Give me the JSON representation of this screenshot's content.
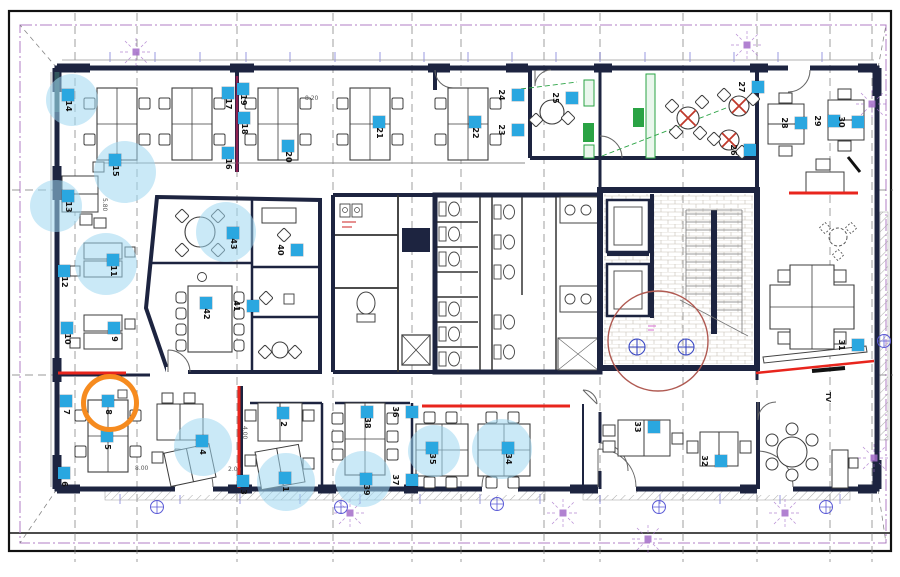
{
  "plan": {
    "title": "office-floor-plan",
    "colors": {
      "marker_blue": "#2aa7e0",
      "highlight_blue": "#9fd7f0",
      "orange_circle": "#f68b1f",
      "annotation_red": "#e8251d",
      "maroon_line": "#8e2050",
      "review_circle_red": "#b05a52",
      "wall_navy": "#1d2440",
      "kitchen_green": "#2aa344",
      "survey_purple": "#a36cc9"
    },
    "texts": {
      "tv_label": "TV",
      "dim_a": "8.20",
      "dim_b": "5.80",
      "dim_c": "8.00",
      "dim_d": "2.00",
      "dim_e": "4.00"
    },
    "markers": [
      {
        "n": "1",
        "x": 285,
        "y": 478
      },
      {
        "n": "2",
        "x": 283,
        "y": 413
      },
      {
        "n": "3",
        "x": 243,
        "y": 481
      },
      {
        "n": "4",
        "x": 202,
        "y": 441
      },
      {
        "n": "5",
        "x": 107,
        "y": 436
      },
      {
        "n": "6",
        "x": 64,
        "y": 473
      },
      {
        "n": "7",
        "x": 66,
        "y": 401
      },
      {
        "n": "8",
        "x": 108,
        "y": 401
      },
      {
        "n": "9",
        "x": 114,
        "y": 328
      },
      {
        "n": "10",
        "x": 67,
        "y": 328
      },
      {
        "n": "11",
        "x": 113,
        "y": 260
      },
      {
        "n": "12",
        "x": 64,
        "y": 271
      },
      {
        "n": "13",
        "x": 68,
        "y": 196
      },
      {
        "n": "14",
        "x": 68,
        "y": 95
      },
      {
        "n": "15",
        "x": 115,
        "y": 160
      },
      {
        "n": "16",
        "x": 228,
        "y": 153
      },
      {
        "n": "17",
        "x": 228,
        "y": 93
      },
      {
        "n": "18",
        "x": 244,
        "y": 118
      },
      {
        "n": "19",
        "x": 243,
        "y": 89
      },
      {
        "n": "20",
        "x": 288,
        "y": 146
      },
      {
        "n": "21",
        "x": 379,
        "y": 122
      },
      {
        "n": "22",
        "x": 475,
        "y": 122
      },
      {
        "n": "23",
        "x": 518,
        "y": 130,
        "ls": "l"
      },
      {
        "n": "24",
        "x": 518,
        "y": 95,
        "ls": "l"
      },
      {
        "n": "25",
        "x": 572,
        "y": 98,
        "ls": "l"
      },
      {
        "n": "26",
        "x": 750,
        "y": 150,
        "ls": "l"
      },
      {
        "n": "27",
        "x": 758,
        "y": 87,
        "ls": "l"
      },
      {
        "n": "28",
        "x": 801,
        "y": 123,
        "ls": "l"
      },
      {
        "n": "29",
        "x": 834,
        "y": 121,
        "ls": "l"
      },
      {
        "n": "30",
        "x": 858,
        "y": 122,
        "ls": "l"
      },
      {
        "n": "31",
        "x": 858,
        "y": 345,
        "ls": "l"
      },
      {
        "n": "32",
        "x": 721,
        "y": 461,
        "ls": "l"
      },
      {
        "n": "33",
        "x": 654,
        "y": 427,
        "ls": "l"
      },
      {
        "n": "34",
        "x": 508,
        "y": 448
      },
      {
        "n": "35",
        "x": 432,
        "y": 448
      },
      {
        "n": "36",
        "x": 412,
        "y": 412,
        "ls": "l"
      },
      {
        "n": "37",
        "x": 412,
        "y": 480,
        "ls": "l"
      },
      {
        "n": "38",
        "x": 367,
        "y": 412
      },
      {
        "n": "39",
        "x": 366,
        "y": 479
      },
      {
        "n": "40",
        "x": 297,
        "y": 250,
        "ls": "l"
      },
      {
        "n": "41",
        "x": 253,
        "y": 306,
        "ls": "l"
      },
      {
        "n": "42",
        "x": 206,
        "y": 303
      },
      {
        "n": "43",
        "x": 233,
        "y": 233
      }
    ],
    "highlights": [
      {
        "x": 72,
        "y": 100,
        "r": 26
      },
      {
        "x": 125,
        "y": 172,
        "r": 31
      },
      {
        "x": 56,
        "y": 206,
        "r": 26
      },
      {
        "x": 106,
        "y": 264,
        "r": 31
      },
      {
        "x": 226,
        "y": 232,
        "r": 30
      },
      {
        "x": 203,
        "y": 447,
        "r": 29
      },
      {
        "x": 286,
        "y": 482,
        "r": 29
      },
      {
        "x": 363,
        "y": 479,
        "r": 28
      },
      {
        "x": 434,
        "y": 451,
        "r": 26
      },
      {
        "x": 502,
        "y": 449,
        "r": 30
      }
    ],
    "orange_circle": {
      "x": 110,
      "y": 403,
      "r": 24
    },
    "review_circle": {
      "x": 658,
      "y": 341,
      "r": 50
    },
    "red_lines": [
      {
        "x1": 237,
        "y1": 76,
        "x2": 237,
        "y2": 172,
        "w": 2.5,
        "color": "maroon"
      },
      {
        "x1": 239,
        "y1": 386,
        "x2": 239,
        "y2": 488,
        "w": 3,
        "color": "red"
      },
      {
        "x1": 422,
        "y1": 406,
        "x2": 570,
        "y2": 406,
        "w": 3,
        "color": "red"
      },
      {
        "x1": 58,
        "y1": 373,
        "x2": 126,
        "y2": 373,
        "w": 3,
        "color": "red"
      },
      {
        "x1": 789,
        "y1": 193,
        "x2": 858,
        "y2": 193,
        "w": 3,
        "color": "red"
      },
      {
        "x1": 756,
        "y1": 373,
        "x2": 874,
        "y2": 361,
        "w": 2.5,
        "color": "red"
      }
    ]
  }
}
